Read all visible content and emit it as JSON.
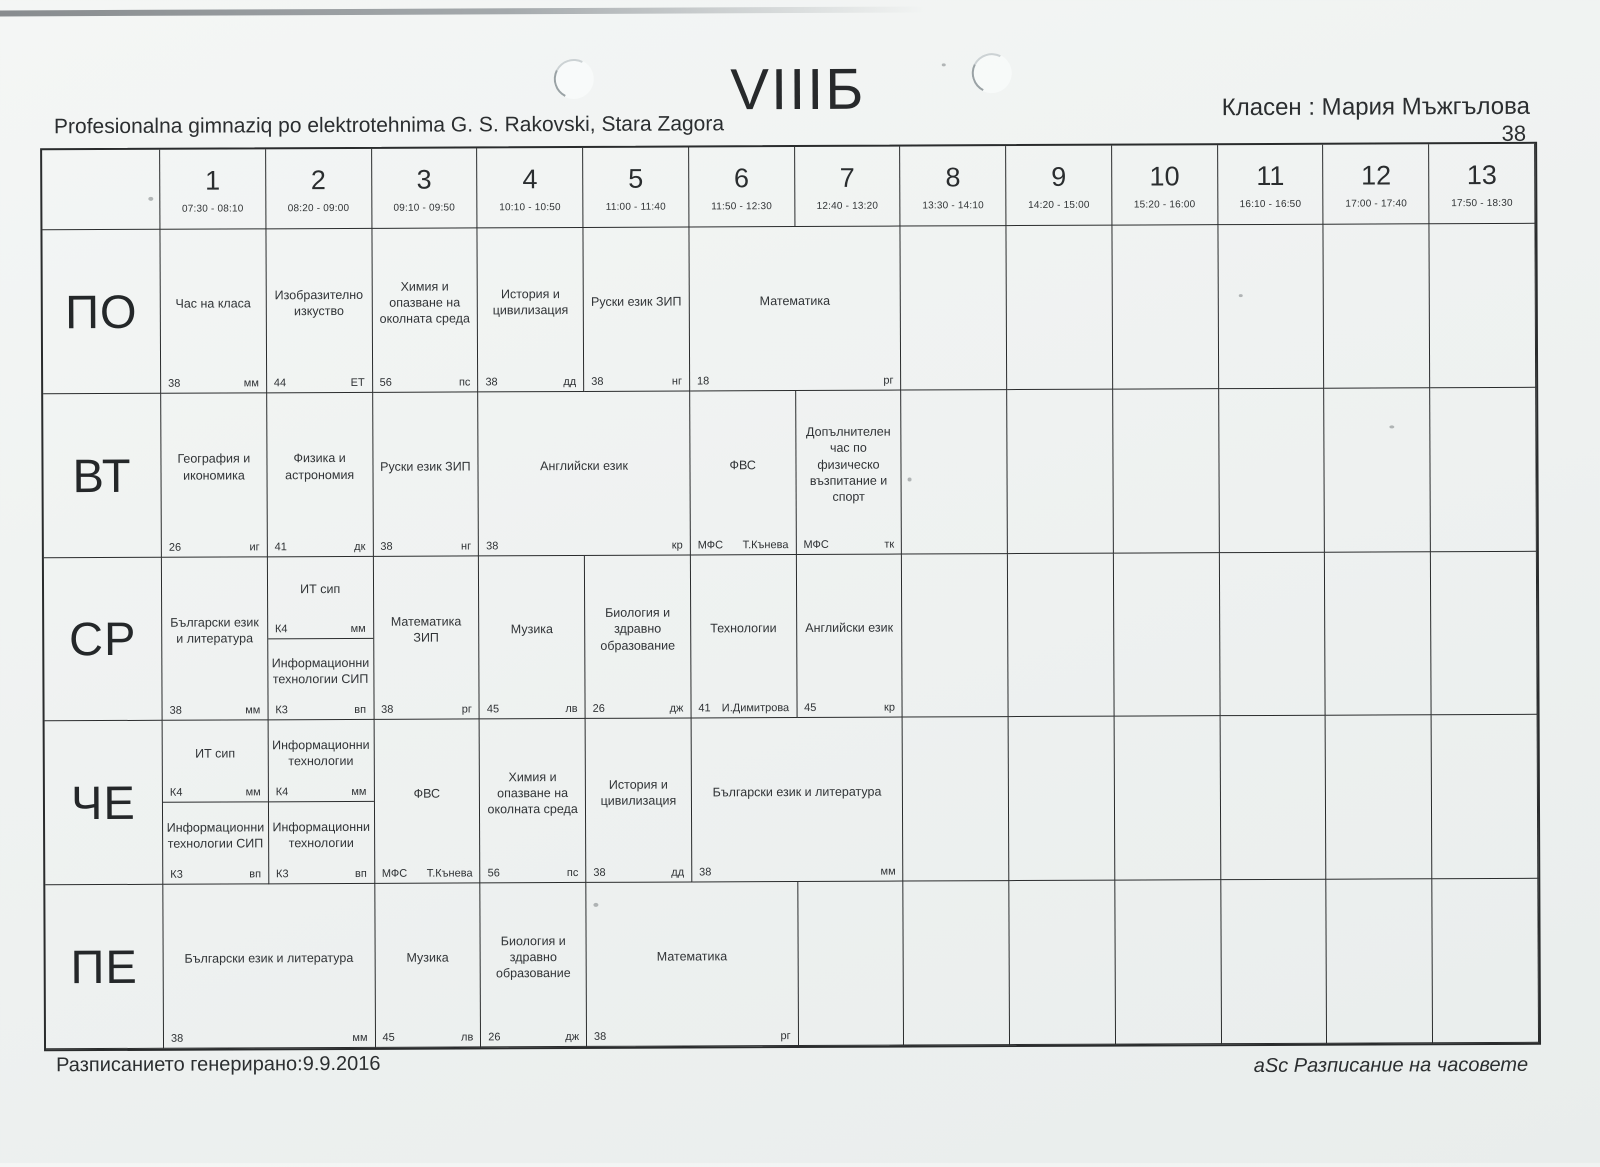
{
  "page": {
    "title": "VIIIБ",
    "school": "Profesionalna gimnaziq po elektrotehnima G. S. Rakovski, Stara Zagora",
    "class_teacher": "Класен : Мария Мъжгълова",
    "class_number": "38",
    "generated": "Разписанието генерирано:9.9.2016",
    "brand": "aSc Разписание на часовете"
  },
  "periods": [
    {
      "num": "1",
      "time": "07:30 - 08:10"
    },
    {
      "num": "2",
      "time": "08:20 - 09:00"
    },
    {
      "num": "3",
      "time": "09:10 - 09:50"
    },
    {
      "num": "4",
      "time": "10:10 - 10:50"
    },
    {
      "num": "5",
      "time": "11:00 - 11:40"
    },
    {
      "num": "6",
      "time": "11:50 - 12:30"
    },
    {
      "num": "7",
      "time": "12:40 - 13:20"
    },
    {
      "num": "8",
      "time": "13:30 - 14:10"
    },
    {
      "num": "9",
      "time": "14:20 - 15:00"
    },
    {
      "num": "10",
      "time": "15:20 - 16:00"
    },
    {
      "num": "11",
      "time": "16:10 - 16:50"
    },
    {
      "num": "12",
      "time": "17:00 - 17:40"
    },
    {
      "num": "13",
      "time": "17:50 - 18:30"
    }
  ],
  "days": [
    {
      "label": "ПО",
      "cells": [
        {
          "subject": "Час на класа",
          "room": "38",
          "teacher": "мм"
        },
        {
          "subject": "Изобразително изкуство",
          "room": "44",
          "teacher": "ЕТ"
        },
        {
          "subject": "Химия и опазване на околната среда",
          "room": "56",
          "teacher": "пс"
        },
        {
          "subject": "История и цивилизация",
          "room": "38",
          "teacher": "дд"
        },
        {
          "subject": "Руски език ЗИП",
          "room": "38",
          "teacher": "нг"
        },
        {
          "subject": "Математика",
          "room": "18",
          "teacher": "рг",
          "span": 2
        }
      ]
    },
    {
      "label": "ВТ",
      "cells": [
        {
          "subject": "География и икономика",
          "room": "26",
          "teacher": "иг"
        },
        {
          "subject": "Физика и астрономия",
          "room": "41",
          "teacher": "дк"
        },
        {
          "subject": "Руски език ЗИП",
          "room": "38",
          "teacher": "нг"
        },
        {
          "subject": "Английски език",
          "room": "38",
          "teacher": "кр",
          "span": 2
        },
        {
          "subject": "ФВС",
          "room": "МФС",
          "teacher": "Т.Кънева"
        },
        {
          "subject": "Допълнителен час по  физическо възпитание и спорт",
          "room": "МФС",
          "teacher": "тк"
        }
      ]
    },
    {
      "label": "СР",
      "cells": [
        {
          "subject": "Български език и литература",
          "room": "38",
          "teacher": "мм"
        },
        {
          "split": [
            {
              "subject": "ИТ сип",
              "room": "К4",
              "teacher": "мм"
            },
            {
              "subject": "Информационни технологии СИП",
              "room": "К3",
              "teacher": "вп"
            }
          ]
        },
        {
          "subject": "Математика ЗИП",
          "room": "38",
          "teacher": "рг"
        },
        {
          "subject": "Музика",
          "room": "45",
          "teacher": "лв"
        },
        {
          "subject": "Биология и здравно образование",
          "room": "26",
          "teacher": "дж"
        },
        {
          "subject": "Технологии",
          "room": "41",
          "teacher": "И.Димитрова"
        },
        {
          "subject": "Английски език",
          "room": "45",
          "teacher": "кр"
        }
      ]
    },
    {
      "label": "ЧЕ",
      "cells": [
        {
          "split": [
            {
              "subject": "ИТ сип",
              "room": "К4",
              "teacher": "мм"
            },
            {
              "subject": "Информационни технологии СИП",
              "room": "К3",
              "teacher": "вп"
            }
          ]
        },
        {
          "split": [
            {
              "subject": "Информационни технологии",
              "room": "К4",
              "teacher": "мм"
            },
            {
              "subject": "Информационни технологии",
              "room": "К3",
              "teacher": "вп"
            }
          ]
        },
        {
          "subject": "ФВС",
          "room": "МФС",
          "teacher": "Т.Кънева"
        },
        {
          "subject": "Химия и опазване на околната среда",
          "room": "56",
          "teacher": "пс"
        },
        {
          "subject": "История и цивилизация",
          "room": "38",
          "teacher": "дд"
        },
        {
          "subject": "Български език и литература",
          "room": "38",
          "teacher": "мм",
          "span": 2
        }
      ]
    },
    {
      "label": "ПЕ",
      "cells": [
        {
          "subject": "Български език и литература",
          "room": "38",
          "teacher": "мм",
          "span": 2
        },
        {
          "subject": "Музика",
          "room": "45",
          "teacher": "лв"
        },
        {
          "subject": "Биология и здравно образование",
          "room": "26",
          "teacher": "дж"
        },
        {
          "subject": "Математика",
          "room": "38",
          "teacher": "рг",
          "span": 2
        }
      ]
    }
  ]
}
